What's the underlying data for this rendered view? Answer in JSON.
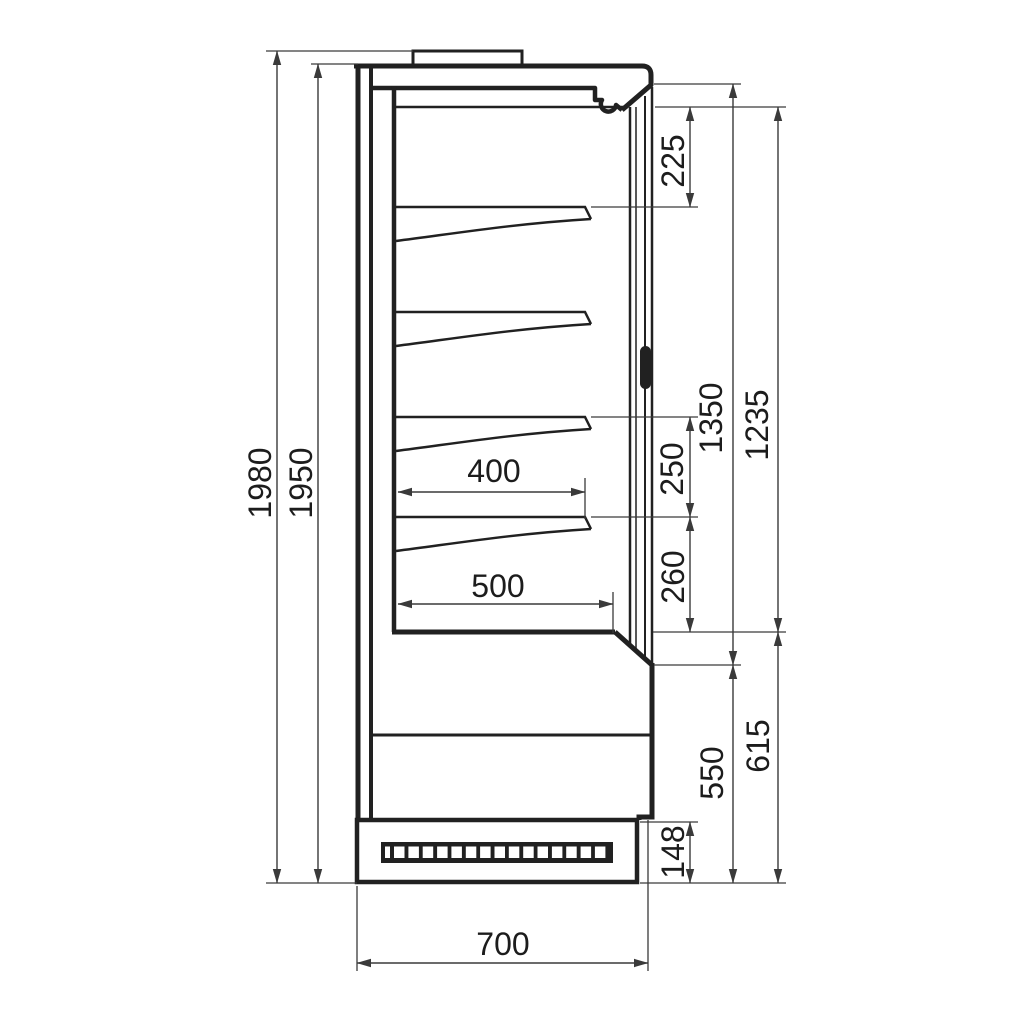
{
  "dims": {
    "overall_height": "1980",
    "body_height": "1950",
    "top_shelf_gap": "225",
    "interior_opening_height": "1350",
    "door_height": "1235",
    "shelf_spacing_upper": "250",
    "shelf_spacing_lower": "260",
    "shelf_depth": "400",
    "base_shelf_depth": "500",
    "base_height_outer": "615",
    "base_height_front": "550",
    "plinth_height": "148",
    "depth": "700"
  },
  "colors": {
    "outline": "#212121",
    "dimension_line": "#3a3a3a",
    "text": "#1c1c1c",
    "background": "#ffffff"
  }
}
